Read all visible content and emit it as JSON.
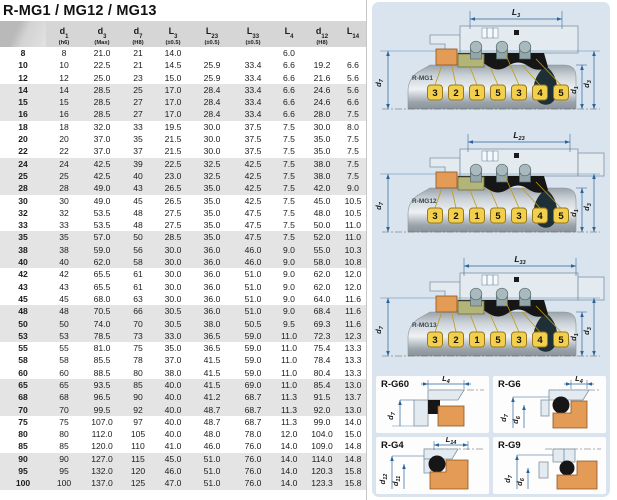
{
  "title": "R-MG1 / MG12 / MG13",
  "table": {
    "columns": [
      {
        "base": "",
        "sub": "",
        "note": ""
      },
      {
        "base": "d",
        "sub": "1",
        "note": "(h6)"
      },
      {
        "base": "d",
        "sub": "3",
        "note": "(Max)"
      },
      {
        "base": "d",
        "sub": "7",
        "note": "(H8)"
      },
      {
        "base": "L",
        "sub": "3",
        "note": "(±0.5)"
      },
      {
        "base": "L",
        "sub": "23",
        "note": "(±0.5)"
      },
      {
        "base": "L",
        "sub": "33",
        "note": "(±0.5)"
      },
      {
        "base": "L",
        "sub": "4",
        "note": ""
      },
      {
        "base": "d",
        "sub": "12",
        "note": "(H8)"
      },
      {
        "base": "L",
        "sub": "14",
        "note": ""
      }
    ],
    "rows": [
      [
        "8",
        "8",
        "21.0",
        "21",
        "14.0",
        "",
        "",
        "6.0",
        "",
        ""
      ],
      [
        "10",
        "10",
        "22.5",
        "21",
        "14.5",
        "25.9",
        "33.4",
        "6.6",
        "19.2",
        "6.6"
      ],
      [
        "12",
        "12",
        "25.0",
        "23",
        "15.0",
        "25.9",
        "33.4",
        "6.6",
        "21.6",
        "5.6"
      ],
      [
        "14",
        "14",
        "28.5",
        "25",
        "17.0",
        "28.4",
        "33.4",
        "6.6",
        "24.6",
        "5.6"
      ],
      [
        "15",
        "15",
        "28.5",
        "27",
        "17.0",
        "28.4",
        "33.4",
        "6.6",
        "24.6",
        "6.6"
      ],
      [
        "16",
        "16",
        "28.5",
        "27",
        "17.0",
        "28.4",
        "33.4",
        "6.6",
        "28.0",
        "7.5"
      ],
      [
        "18",
        "18",
        "32.0",
        "33",
        "19.5",
        "30.0",
        "37.5",
        "7.5",
        "30.0",
        "8.0"
      ],
      [
        "20",
        "20",
        "37.0",
        "35",
        "21.5",
        "30.0",
        "37.5",
        "7.5",
        "35.0",
        "7.5"
      ],
      [
        "22",
        "22",
        "37.0",
        "37",
        "21.5",
        "30.0",
        "37.5",
        "7.5",
        "35.0",
        "7.5"
      ],
      [
        "24",
        "24",
        "42.5",
        "39",
        "22.5",
        "32.5",
        "42.5",
        "7.5",
        "38.0",
        "7.5"
      ],
      [
        "25",
        "25",
        "42.5",
        "40",
        "23.0",
        "32.5",
        "42.5",
        "7.5",
        "38.0",
        "7.5"
      ],
      [
        "28",
        "28",
        "49.0",
        "43",
        "26.5",
        "35.0",
        "42.5",
        "7.5",
        "42.0",
        "9.0"
      ],
      [
        "30",
        "30",
        "49.0",
        "45",
        "26.5",
        "35.0",
        "42.5",
        "7.5",
        "45.0",
        "10.5"
      ],
      [
        "32",
        "32",
        "53.5",
        "48",
        "27.5",
        "35.0",
        "47.5",
        "7.5",
        "48.0",
        "10.5"
      ],
      [
        "33",
        "33",
        "53.5",
        "48",
        "27.5",
        "35.0",
        "47.5",
        "7.5",
        "50.0",
        "11.0"
      ],
      [
        "35",
        "35",
        "57.0",
        "50",
        "28.5",
        "35.0",
        "47.5",
        "7.5",
        "52.0",
        "11.0"
      ],
      [
        "38",
        "38",
        "59.0",
        "56",
        "30.0",
        "36.0",
        "46.0",
        "9.0",
        "55.0",
        "10.3"
      ],
      [
        "40",
        "40",
        "62.0",
        "58",
        "30.0",
        "36.0",
        "46.0",
        "9.0",
        "58.0",
        "10.8"
      ],
      [
        "42",
        "42",
        "65.5",
        "61",
        "30.0",
        "36.0",
        "51.0",
        "9.0",
        "62.0",
        "12.0"
      ],
      [
        "43",
        "43",
        "65.5",
        "61",
        "30.0",
        "36.0",
        "51.0",
        "9.0",
        "62.0",
        "12.0"
      ],
      [
        "45",
        "45",
        "68.0",
        "63",
        "30.0",
        "36.0",
        "51.0",
        "9.0",
        "64.0",
        "11.6"
      ],
      [
        "48",
        "48",
        "70.5",
        "66",
        "30.5",
        "36.0",
        "51.0",
        "9.0",
        "68.4",
        "11.6"
      ],
      [
        "50",
        "50",
        "74.0",
        "70",
        "30.5",
        "38.0",
        "50.5",
        "9.5",
        "69.3",
        "11.6"
      ],
      [
        "53",
        "53",
        "78.5",
        "73",
        "33.0",
        "36.5",
        "59.0",
        "11.0",
        "72.3",
        "12.3"
      ],
      [
        "55",
        "55",
        "81.0",
        "75",
        "35.0",
        "36.5",
        "59.0",
        "11.0",
        "75.4",
        "13.3"
      ],
      [
        "58",
        "58",
        "85.5",
        "78",
        "37.0",
        "41.5",
        "59.0",
        "11.0",
        "78.4",
        "13.3"
      ],
      [
        "60",
        "60",
        "88.5",
        "80",
        "38.0",
        "41.5",
        "59.0",
        "11.0",
        "80.4",
        "13.3"
      ],
      [
        "65",
        "65",
        "93.5",
        "85",
        "40.0",
        "41.5",
        "69.0",
        "11.0",
        "85.4",
        "13.0"
      ],
      [
        "68",
        "68",
        "96.5",
        "90",
        "40.0",
        "41.2",
        "68.7",
        "11.3",
        "91.5",
        "13.7"
      ],
      [
        "70",
        "70",
        "99.5",
        "92",
        "40.0",
        "48.7",
        "68.7",
        "11.3",
        "92.0",
        "13.0"
      ],
      [
        "75",
        "75",
        "107.0",
        "97",
        "40.0",
        "48.7",
        "68.7",
        "11.3",
        "99.0",
        "14.0"
      ],
      [
        "80",
        "80",
        "112.0",
        "105",
        "40.0",
        "48.0",
        "78.0",
        "12.0",
        "104.0",
        "15.0"
      ],
      [
        "85",
        "85",
        "120.0",
        "110",
        "41.0",
        "46.0",
        "76.0",
        "14.0",
        "109.0",
        "14.8"
      ],
      [
        "90",
        "90",
        "127.0",
        "115",
        "45.0",
        "51.0",
        "76.0",
        "14.0",
        "114.0",
        "14.8"
      ],
      [
        "95",
        "95",
        "132.0",
        "120",
        "46.0",
        "51.0",
        "76.0",
        "14.0",
        "120.3",
        "15.8"
      ],
      [
        "100",
        "100",
        "137.0",
        "125",
        "47.0",
        "51.0",
        "76.0",
        "14.0",
        "123.3",
        "15.8"
      ]
    ]
  },
  "diagrams": [
    {
      "name": "R-MG1",
      "top_dim": {
        "base": "L",
        "sub": "3"
      },
      "left_dim": {
        "base": "d",
        "sub": "7"
      },
      "right_dims": [
        {
          "base": "d",
          "sub": "1"
        },
        {
          "base": "d",
          "sub": "3"
        }
      ],
      "callouts": [
        "3",
        "2",
        "1",
        "5",
        "3",
        "4",
        "5"
      ]
    },
    {
      "name": "R-MG12",
      "top_dim": {
        "base": "L",
        "sub": "23"
      },
      "left_dim": {
        "base": "d",
        "sub": "7"
      },
      "right_dims": [
        {
          "base": "d",
          "sub": "1"
        },
        {
          "base": "d",
          "sub": "3"
        }
      ],
      "callouts": [
        "3",
        "2",
        "1",
        "5",
        "3",
        "4",
        "5"
      ]
    },
    {
      "name": "R-MG13",
      "top_dim": {
        "base": "L",
        "sub": "33"
      },
      "left_dim": {
        "base": "d",
        "sub": "7"
      },
      "right_dims": [
        {
          "base": "d",
          "sub": "1"
        },
        {
          "base": "d",
          "sub": "3"
        }
      ],
      "callouts": [
        "3",
        "2",
        "1",
        "5",
        "3",
        "4",
        "5"
      ]
    }
  ],
  "details": [
    {
      "name": "R-G60",
      "top_dim": {
        "base": "L",
        "sub": "4"
      },
      "left_dims": [
        {
          "base": "d",
          "sub": "7"
        }
      ]
    },
    {
      "name": "R-G6",
      "top_dim": {
        "base": "L",
        "sub": "4"
      },
      "left_dims": [
        {
          "base": "d",
          "sub": "7"
        },
        {
          "base": "d",
          "sub": "6"
        }
      ]
    },
    {
      "name": "R-G4",
      "top_dim": {
        "base": "L",
        "sub": "14"
      },
      "left_dims": [
        {
          "base": "d",
          "sub": "12"
        },
        {
          "base": "d",
          "sub": "11"
        }
      ]
    },
    {
      "name": "R-G9",
      "top_dim": null,
      "left_dims": [
        {
          "base": "d",
          "sub": "7"
        },
        {
          "base": "d",
          "sub": "6"
        }
      ]
    }
  ],
  "colors": {
    "panel_bg": "#d9e4ee",
    "header_gray": "#d6d6d6",
    "row_alt": "#e4e4e4",
    "dim_blue": "#2a6399",
    "callout_yellow": "#f3cf4e",
    "seat_orange": "#e49b56",
    "ring_olive": "#b3b578",
    "elastomer_black": "#161616",
    "housing": "#e3eaf0",
    "leader_yellow": "#c29b10"
  }
}
